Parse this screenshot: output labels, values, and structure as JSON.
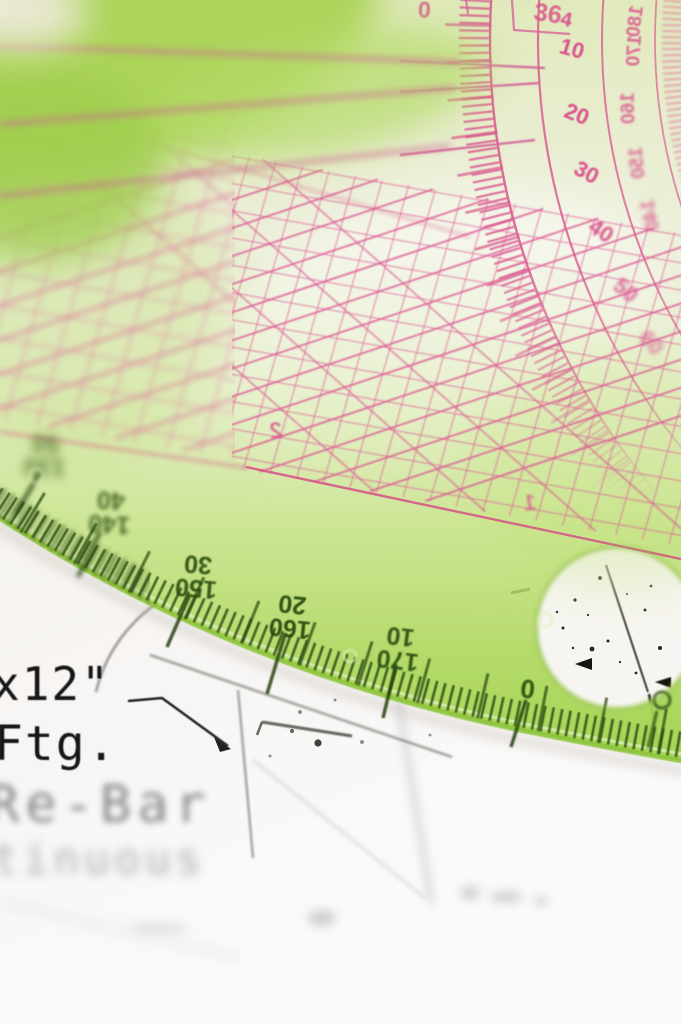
{
  "scene": {
    "description": "Macro photo of a pink circular protractor with grid ruler and a green protractor lying on a construction drawing"
  },
  "pink_protractor": {
    "color": "#d9538b",
    "inner_scale": [
      "4",
      "10",
      "20",
      "30",
      "40",
      "50",
      "60"
    ],
    "outer_scale_mirrored": [
      "180",
      "170",
      "160",
      "150",
      "140"
    ],
    "top_scale": [
      "0",
      "36"
    ]
  },
  "grid_sheet": {
    "color": "#e0609a",
    "digits_mirrored": [
      "2",
      "1"
    ]
  },
  "green_protractor": {
    "color": "#9ccf44",
    "tick_color": "#2e4d15",
    "labels": [
      {
        "outer": "130",
        "inner": "50"
      },
      {
        "outer": "140",
        "inner": "40"
      },
      {
        "outer": "150",
        "inner": "30"
      },
      {
        "outer": "160",
        "inner": "20"
      },
      {
        "outer": "170",
        "inner": "10"
      },
      {
        "outer": "0",
        "inner": ""
      }
    ]
  },
  "drawing": {
    "ink_color": "#1b1b1b",
    "line1": "x12\"",
    "line2": "Ftg.",
    "line3": "Re-Bar",
    "line4": "tinuous"
  }
}
